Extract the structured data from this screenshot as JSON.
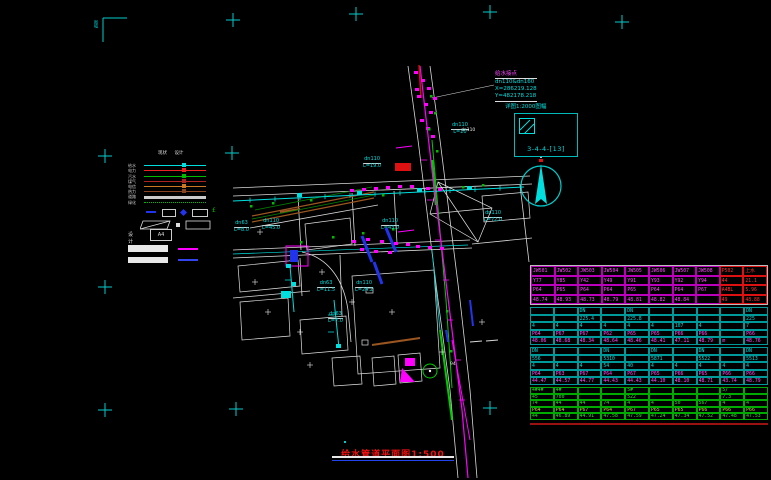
{
  "colors": {
    "bg": "#000000",
    "cyan": "#00dede",
    "magenta": "#ff00ff",
    "green": "#00bb00",
    "red": "#ee1111",
    "blue": "#2233ee",
    "white": "#e8e8e8"
  },
  "annotations": {
    "title": "给水管道平面图1:500",
    "frame_corner": "图幅",
    "junction": {
      "title": "给水接点",
      "line1": "dn110&dn160",
      "line2": "X=286219.128",
      "line3": "Y=482178.218"
    },
    "detail": {
      "caption": "详图1:2000图幅",
      "label": "3-4-4-[13]"
    },
    "white_labels": [
      {
        "t": "dn110",
        "x": 461,
        "y": 129
      },
      {
        "t": "94",
        "x": 450,
        "y": 363
      }
    ]
  },
  "legend": {
    "headers": [
      "现状",
      "设计"
    ],
    "rows": [
      {
        "label": "给水",
        "color": "#00dede",
        "style": "solid"
      },
      {
        "label": "电力",
        "color": "#ee2222",
        "style": "solid"
      },
      {
        "label": "污水",
        "color": "#00bb00",
        "style": "solid"
      },
      {
        "label": "煤气",
        "color": "#aa2222",
        "style": "solid"
      },
      {
        "label": "电信",
        "color": "#cc7722",
        "style": "solid"
      },
      {
        "label": "热力",
        "color": "#884422",
        "style": "solid"
      },
      {
        "label": "道路",
        "color": "#cccccc",
        "style": "thick"
      },
      {
        "label": "绿化",
        "color": "#00bb00",
        "style": "dotted"
      }
    ],
    "symbol_glyph": "£",
    "design_label": "设计",
    "paper_size": "A4"
  },
  "map_labels": [
    {
      "d": "dn63",
      "l": "L=8.0",
      "x": 234,
      "y": 221
    },
    {
      "d": "dn110",
      "l": "L=45.0",
      "x": 262,
      "y": 219
    },
    {
      "d": "dn110",
      "l": "L=43.0",
      "x": 381,
      "y": 219
    },
    {
      "d": "dn63",
      "l": "L=11.5",
      "x": 317,
      "y": 281
    },
    {
      "d": "dn110",
      "l": "L=24.2",
      "x": 355,
      "y": 281
    },
    {
      "d": "dn110",
      "l": "L=72.0",
      "x": 484,
      "y": 211
    },
    {
      "d": "dn110",
      "l": "L=19.0",
      "x": 363,
      "y": 157
    },
    {
      "d": "dn110",
      "l": "L=20",
      "x": 451,
      "y": 123
    },
    {
      "d": "dn63",
      "l": "L=7.0",
      "x": 328,
      "y": 312
    }
  ],
  "table": {
    "sections": [
      {
        "cls": "s1",
        "red_from": 8,
        "rows": [
          {
            "c": "m",
            "cells": [
              "JW501",
              "JW502",
              "JW503",
              "JW504",
              "JW505",
              "JW506",
              "JW507",
              "JW508",
              "P502",
              "上水"
            ]
          },
          {
            "c": "m",
            "cells": [
              "Y77",
              "Y85",
              "Y42",
              "Y49",
              "Y91",
              "Y93",
              "Y92",
              "Y94",
              "44",
              "21.1"
            ]
          },
          {
            "c": "m",
            "cells": [
              "P64",
              "P65",
              "P64",
              "P64",
              "P65",
              "P64",
              "P64",
              "P67",
              "A4BL",
              "5.96"
            ]
          },
          {
            "c": "m",
            "cells": [
              "48.74",
              "48.93",
              "48.73",
              "48.79",
              "48.81",
              "48.82",
              "48.84",
              "",
              "49",
              "48.88"
            ]
          }
        ]
      },
      {
        "cls": "s2",
        "rows": [
          {
            "c": "c",
            "cells": [
              "",
              "",
              "DN",
              "",
              "DN",
              "",
              "",
              "",
              "",
              "DN"
            ]
          },
          {
            "c": "c",
            "cells": [
              "",
              "",
              "225.4",
              "",
              "225.8",
              "",
              "",
              "",
              "",
              "225"
            ]
          },
          {
            "c": "c",
            "cells": [
              "4",
              "4",
              "4",
              "4",
              "4",
              "4",
              "107",
              "4",
              "",
              "7"
            ]
          },
          {
            "c": "m",
            "cells": [
              "P64",
              "P67",
              "P67",
              "P62",
              "P65",
              "P65",
              "P66",
              "P66",
              "",
              "P66"
            ]
          },
          {
            "c": "m",
            "cells": [
              "48.06",
              "48.68",
              "48.34",
              "48.64",
              "48.46",
              "48.41",
              "47.11",
              "48.79",
              "m",
              "48.76"
            ]
          }
        ]
      },
      {
        "cls": "s2",
        "rows": [
          {
            "c": "c",
            "cells": [
              "DN",
              "",
              "",
              "DN",
              "",
              "DN",
              "",
              "DN",
              "",
              "DN"
            ]
          },
          {
            "c": "c",
            "cells": [
              "556",
              "",
              "",
              "5310",
              "",
              "5871",
              "",
              "5522",
              "",
              "5513"
            ]
          },
          {
            "c": "c",
            "cells": [
              "4",
              "4",
              "4",
              "54",
              "40",
              "4",
              "4",
              "4",
              "4",
              "4"
            ]
          },
          {
            "c": "m",
            "cells": [
              "P64",
              "P63",
              "P67",
              "P64",
              "P67",
              "P65",
              "P66",
              "P65",
              "P66",
              "P66"
            ]
          },
          {
            "c": "m",
            "cells": [
              "44.47",
              "44.57",
              "44.77",
              "44.43",
              "44.43",
              "44.10",
              "48.10",
              "48.71",
              "43.74",
              "48.79"
            ]
          }
        ]
      },
      {
        "cls": "s4",
        "rows": [
          {
            "c": "g",
            "cells": [
              "4#4#",
              "4#",
              "",
              "",
              "5#",
              "",
              "",
              "",
              "5/",
              ""
            ]
          },
          {
            "c": "g",
            "cells": [
              "45",
              "700",
              "",
              "",
              "522",
              "",
              "",
              "",
              "7.3",
              ""
            ]
          },
          {
            "c": "g",
            "cells": [
              "74",
              "44",
              "44",
              "74",
              "4",
              "4",
              "50",
              "567",
              "4",
              "4"
            ]
          },
          {
            "c": "gm",
            "cells": [
              "P64",
              "P64",
              "P67",
              "P64",
              "P67",
              "P65",
              "P65",
              "P66",
              "P66",
              "P66"
            ]
          },
          {
            "c": "g",
            "cells": [
              "44",
              "46.89",
              "44.91",
              "47.58",
              "47.59",
              "47.24",
              "47.34",
              "47.52",
              "47.48",
              "47.53"
            ]
          }
        ]
      }
    ]
  }
}
